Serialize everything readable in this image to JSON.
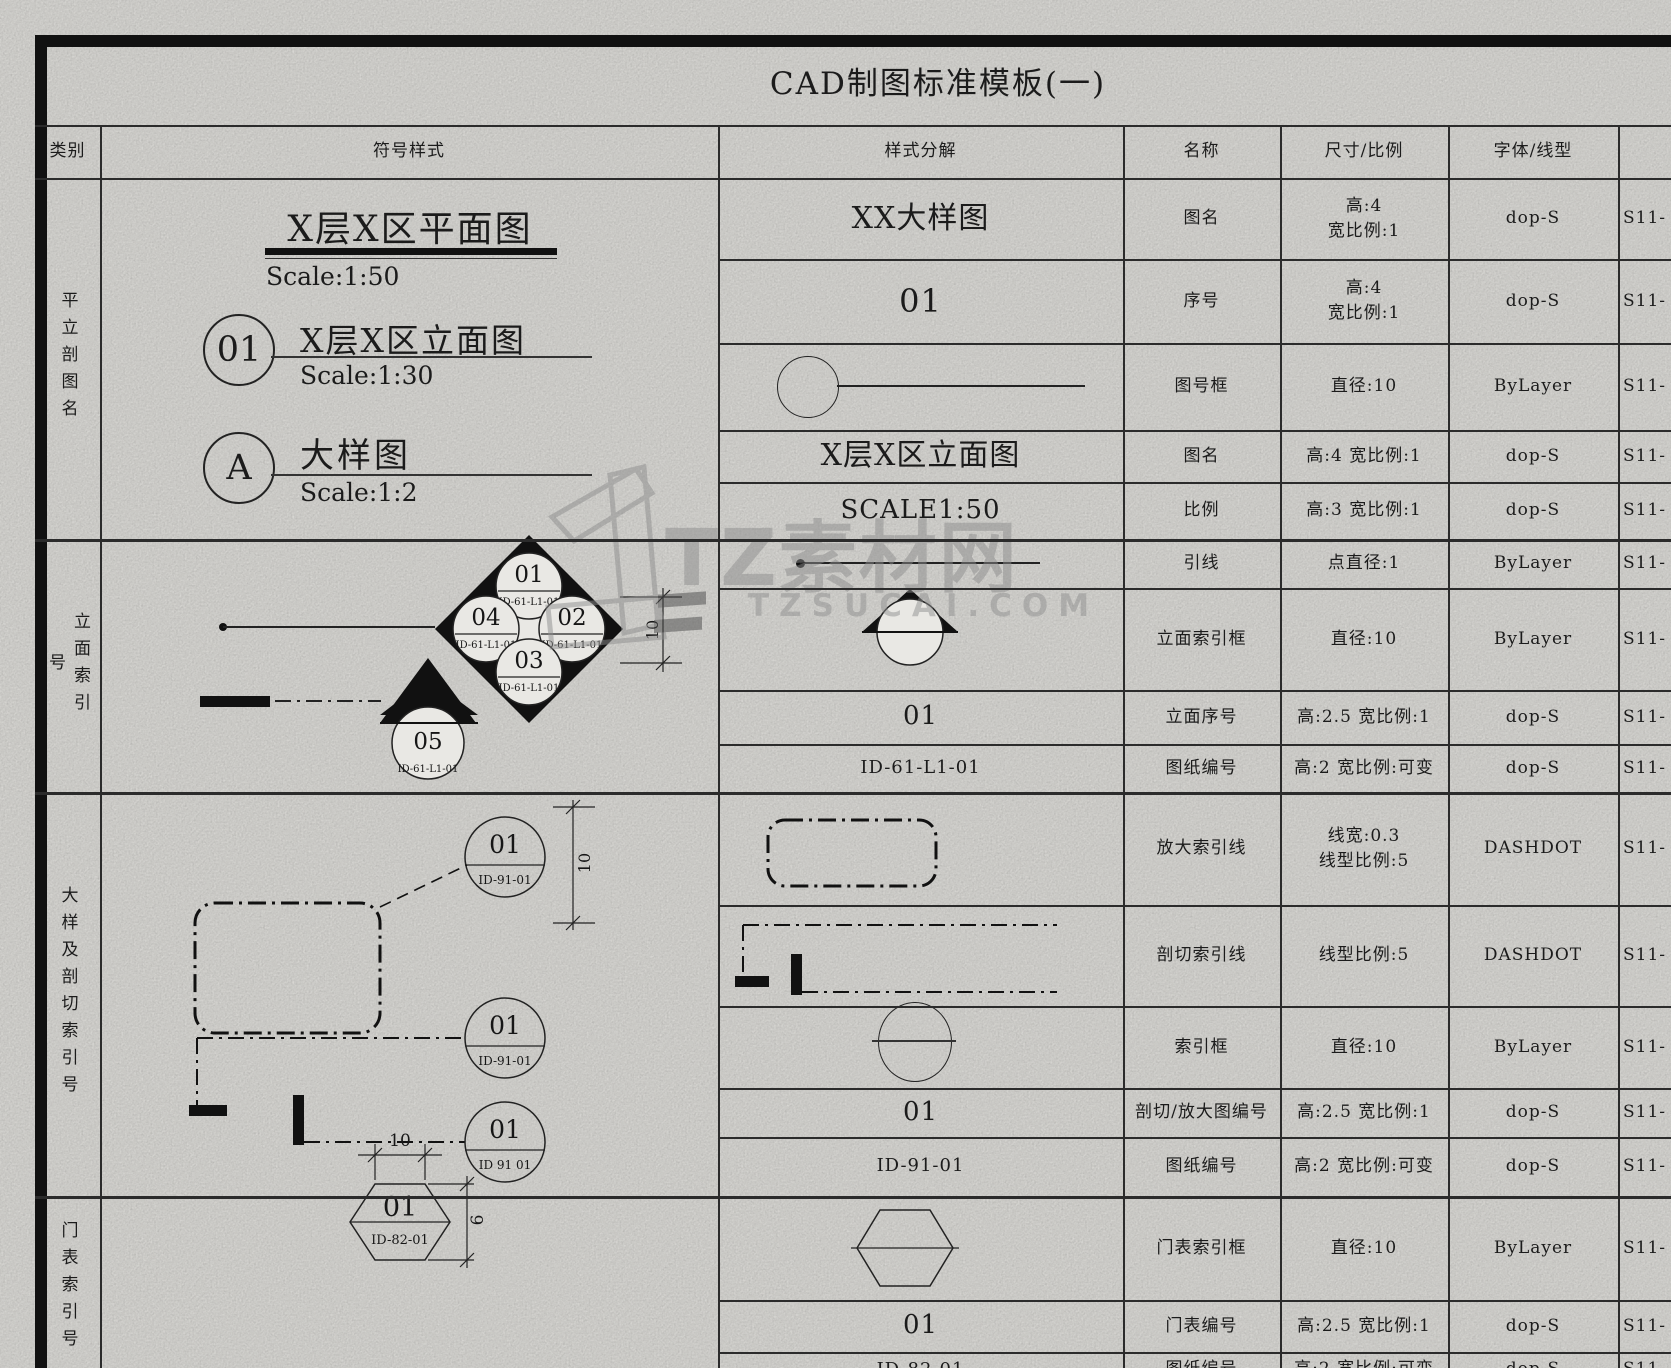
{
  "page_title": "CAD制图标准模板(一)",
  "header": {
    "col_category": "类别",
    "col_symbol_style": "符号样式",
    "col_style_breakdown": "样式分解",
    "col_name": "名称",
    "col_size_scale": "尺寸/比例",
    "col_font_linetype": "字体/线型"
  },
  "sections": [
    {
      "category": "平立剖图名"
    },
    {
      "category": "立面索引号"
    },
    {
      "category": "大样及剖切索引号"
    },
    {
      "category": "门表索引号"
    }
  ],
  "rows": [
    {
      "content": "XX大样图",
      "name": "图名",
      "size": "高:4\n宽比例:1",
      "font": "dop-S",
      "layer": "S11-"
    },
    {
      "content": "01",
      "name": "序号",
      "size": "高:4\n宽比例:1",
      "font": "dop-S",
      "layer": "S11-"
    },
    {
      "content": "",
      "name": "图号框",
      "size": "直径:10",
      "font": "ByLayer",
      "layer": "S11-"
    },
    {
      "content": "X层X区立面图",
      "name": "图名",
      "size": "高:4 宽比例:1",
      "font": "dop-S",
      "layer": "S11-"
    },
    {
      "content": "SCALE1:50",
      "name": "比例",
      "size": "高:3 宽比例:1",
      "font": "dop-S",
      "layer": "S11-"
    },
    {
      "content": "",
      "name": "引线",
      "size": "点直径:1",
      "font": "ByLayer",
      "layer": "S11-"
    },
    {
      "content": "",
      "name": "立面索引框",
      "size": "直径:10",
      "font": "ByLayer",
      "layer": "S11-"
    },
    {
      "content": "01",
      "name": "立面序号",
      "size": "高:2.5 宽比例:1",
      "font": "dop-S",
      "layer": "S11-"
    },
    {
      "content": "ID-61-L1-01",
      "name": "图纸编号",
      "size": "高:2 宽比例:可变",
      "font": "dop-S",
      "layer": "S11-"
    },
    {
      "content": "",
      "name": "放大索引线",
      "size": "线宽:0.3\n线型比例:5",
      "font": "DASHDOT",
      "layer": "S11-"
    },
    {
      "content": "",
      "name": "剖切索引线",
      "size": "线型比例:5",
      "font": "DASHDOT",
      "layer": "S11-"
    },
    {
      "content": "",
      "name": "索引框",
      "size": "直径:10",
      "font": "ByLayer",
      "layer": "S11-"
    },
    {
      "content": "01",
      "name": "剖切/放大图编号",
      "size": "高:2.5 宽比例:1",
      "font": "dop-S",
      "layer": "S11-"
    },
    {
      "content": "ID-91-01",
      "name": "图纸编号",
      "size": "高:2 宽比例:可变",
      "font": "dop-S",
      "layer": "S11-"
    },
    {
      "content": "",
      "name": "门表索引框",
      "size": "直径:10",
      "font": "ByLayer",
      "layer": "S11-"
    },
    {
      "content": "01",
      "name": "门表编号",
      "size": "高:2.5 宽比例:1",
      "font": "dop-S",
      "layer": "S11-"
    },
    {
      "content": "ID-82-01",
      "name": "图纸编号",
      "size": "高:2 宽比例:可变",
      "font": "dop-S",
      "layer": "S11-"
    }
  ],
  "symbols": {
    "plan_title": {
      "text": "X层X区平面图",
      "scale": "Scale:1:50"
    },
    "elev_title": {
      "bubble": "01",
      "text": "X层X区立面图",
      "scale": "Scale:1:30"
    },
    "detail_title": {
      "bubble": "A",
      "text": "大样图",
      "scale": "Scale:1:2"
    },
    "elev_index": {
      "n": "01",
      "e": "02",
      "s": "03",
      "w": "04",
      "extra": "05",
      "sheet": "ID-61-L1-01",
      "dim": "10"
    },
    "section_index": {
      "num": "01",
      "sheet1": "ID-91-01",
      "sheet2": "ID-91-01",
      "sheet3": "ID 91 01",
      "dim": "10"
    },
    "door_index": {
      "num": "01",
      "sheet": "ID-82-01",
      "dim_w": "10",
      "dim_h": "6"
    }
  },
  "watermark": {
    "brand": "TZ素材网",
    "domain": "TZSUCAI.COM"
  }
}
